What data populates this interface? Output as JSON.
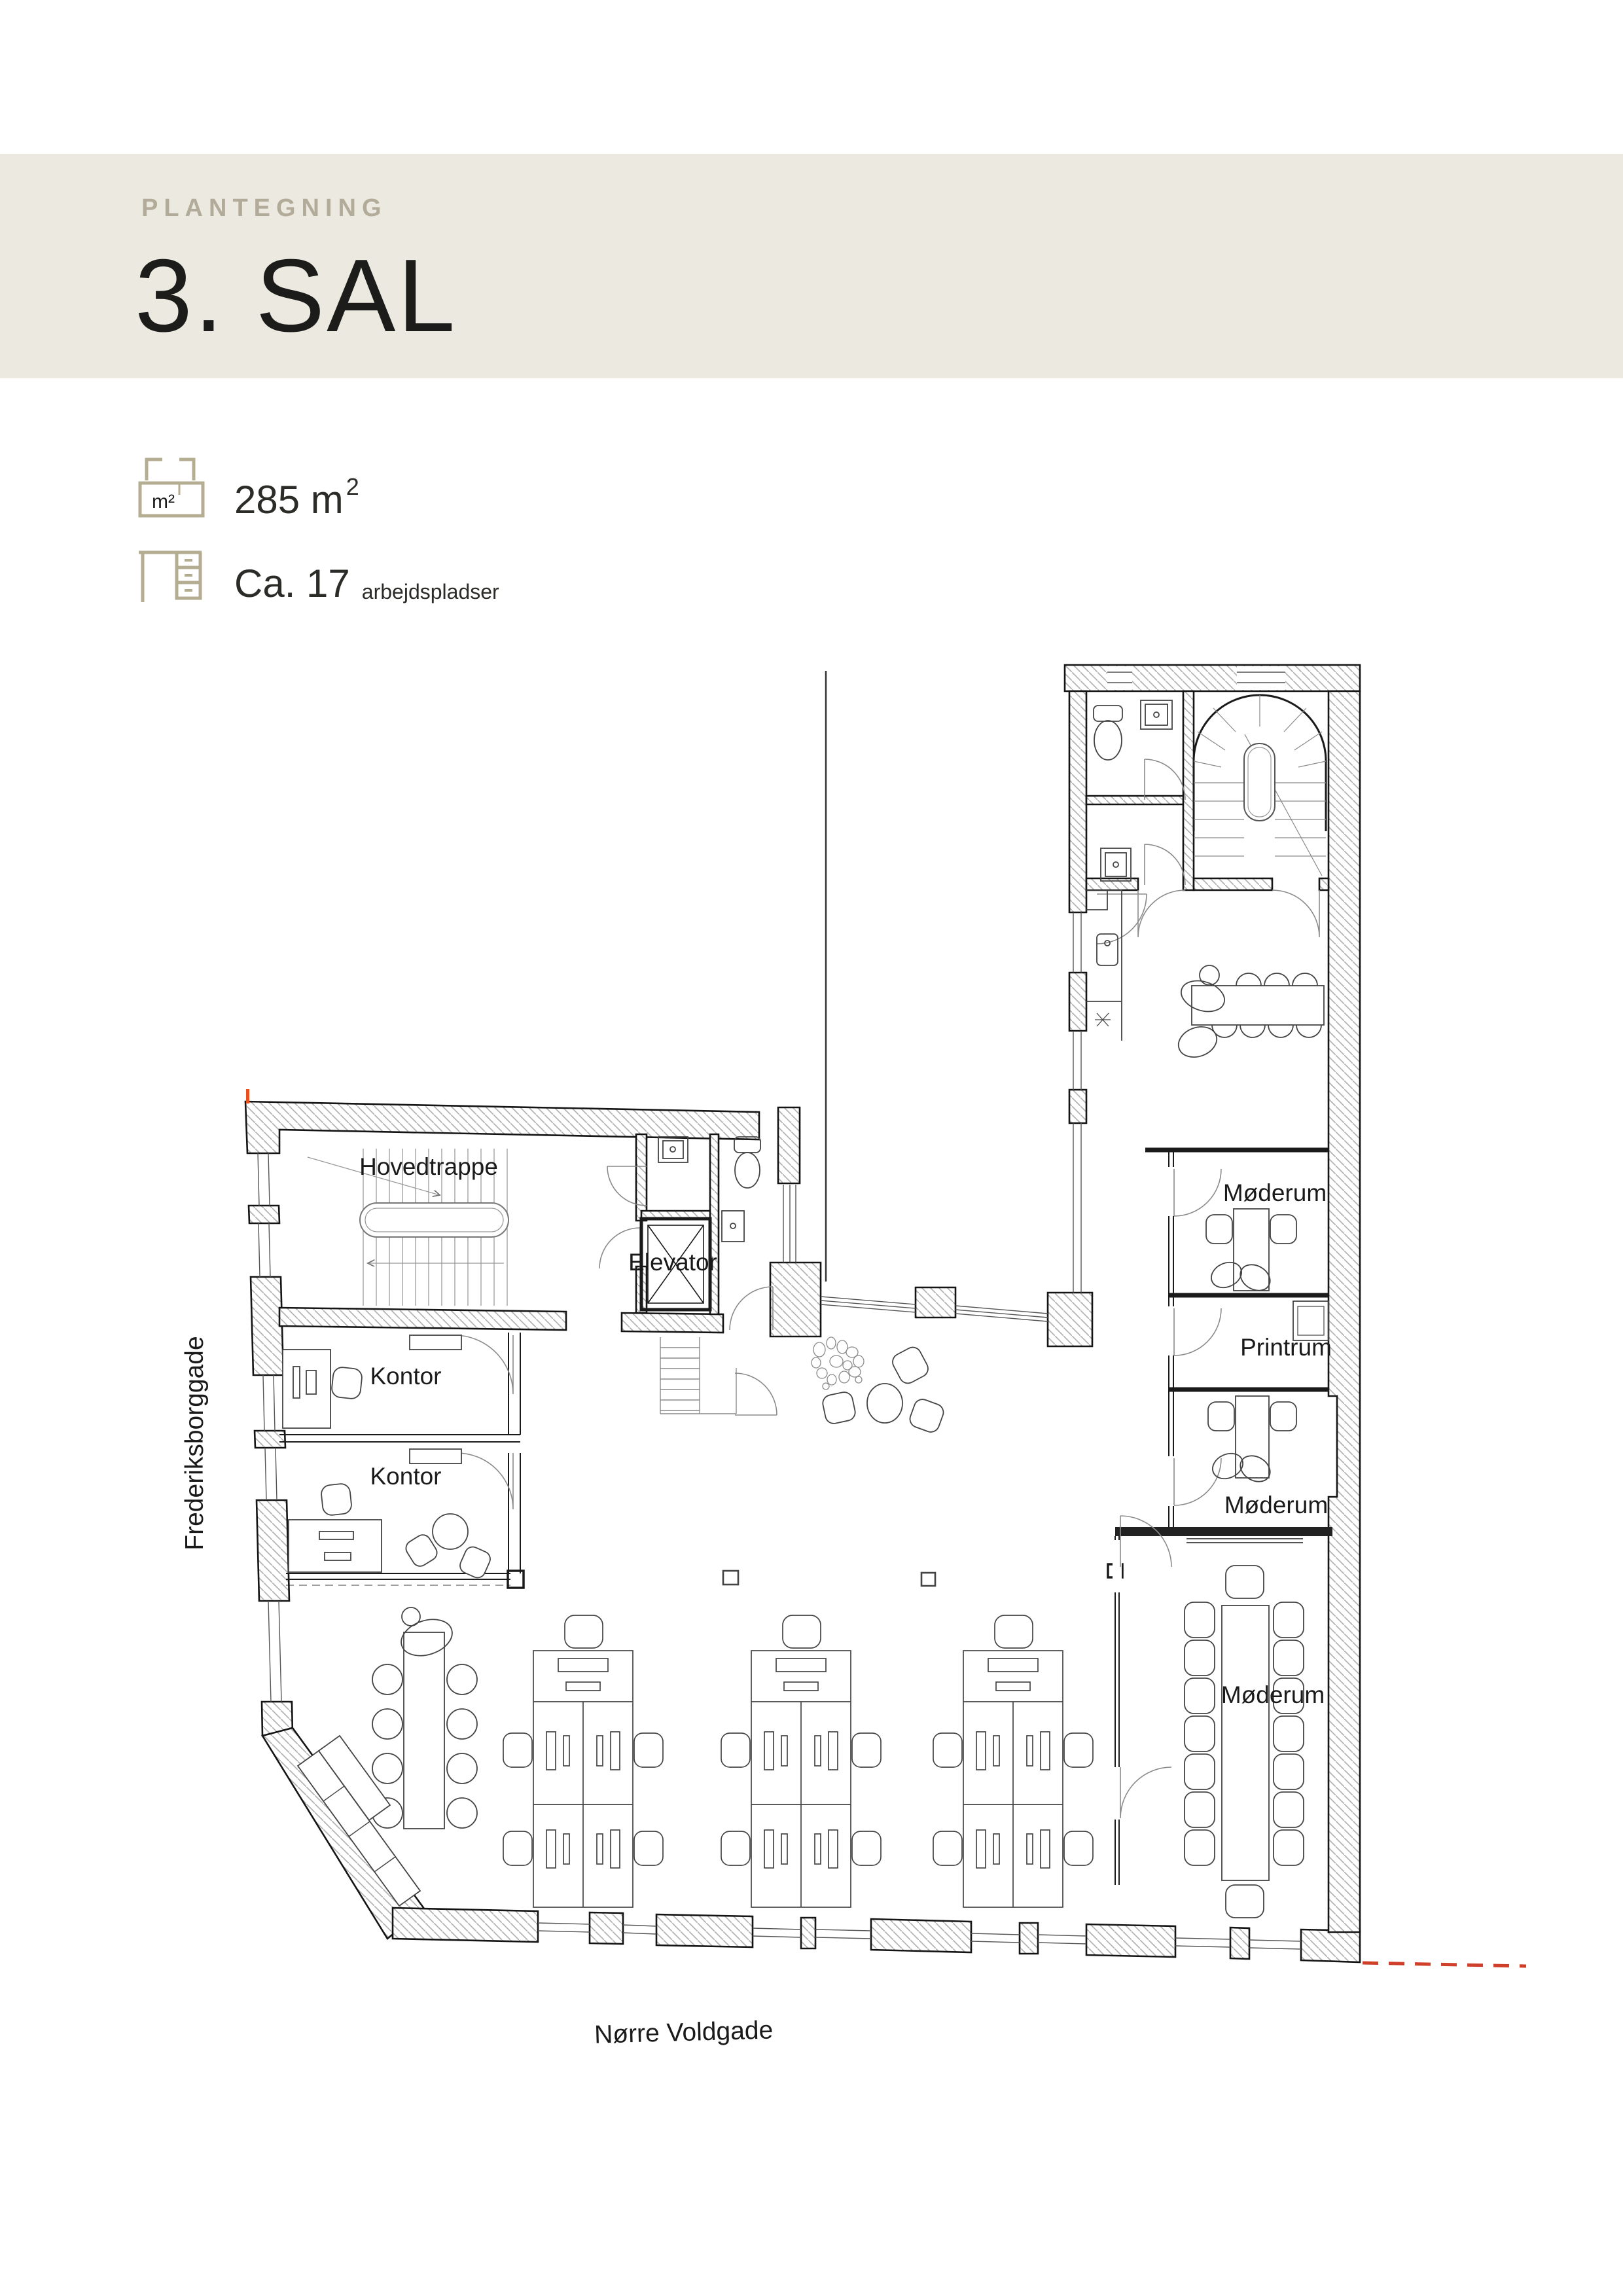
{
  "header": {
    "eyebrow": "PLANTEGNING",
    "title": "3. SAL"
  },
  "stats": {
    "area": {
      "icon": "floorplan-m2-icon",
      "icon_label": "m²",
      "value": "285 m",
      "sup": "2"
    },
    "workspaces": {
      "icon": "desk-icon",
      "value": "Ca. 17",
      "unit": "arbejdspladser"
    }
  },
  "plan": {
    "rooms": [
      {
        "label": "Hovedtrappe"
      },
      {
        "label": "Elevator"
      },
      {
        "label": "Kontor"
      },
      {
        "label": "Kontor"
      },
      {
        "label": "Møderum"
      },
      {
        "label": "Printrum"
      },
      {
        "label": "Møderum"
      },
      {
        "label": "Møderum"
      }
    ],
    "streets": [
      {
        "label": "Frederiksborggade"
      },
      {
        "label": "Nørre Voldgade"
      }
    ]
  },
  "colors": {
    "band": "#ece9e0",
    "muted_text": "#b2ab9a",
    "ink": "#1d1d1b",
    "icon_stroke": "#b5ad92",
    "plan_line": "#1a1a1a",
    "light_line": "#8a8a8a",
    "hatch_line": "#b3b3b3",
    "accent_dash": "#cf3f2a"
  }
}
